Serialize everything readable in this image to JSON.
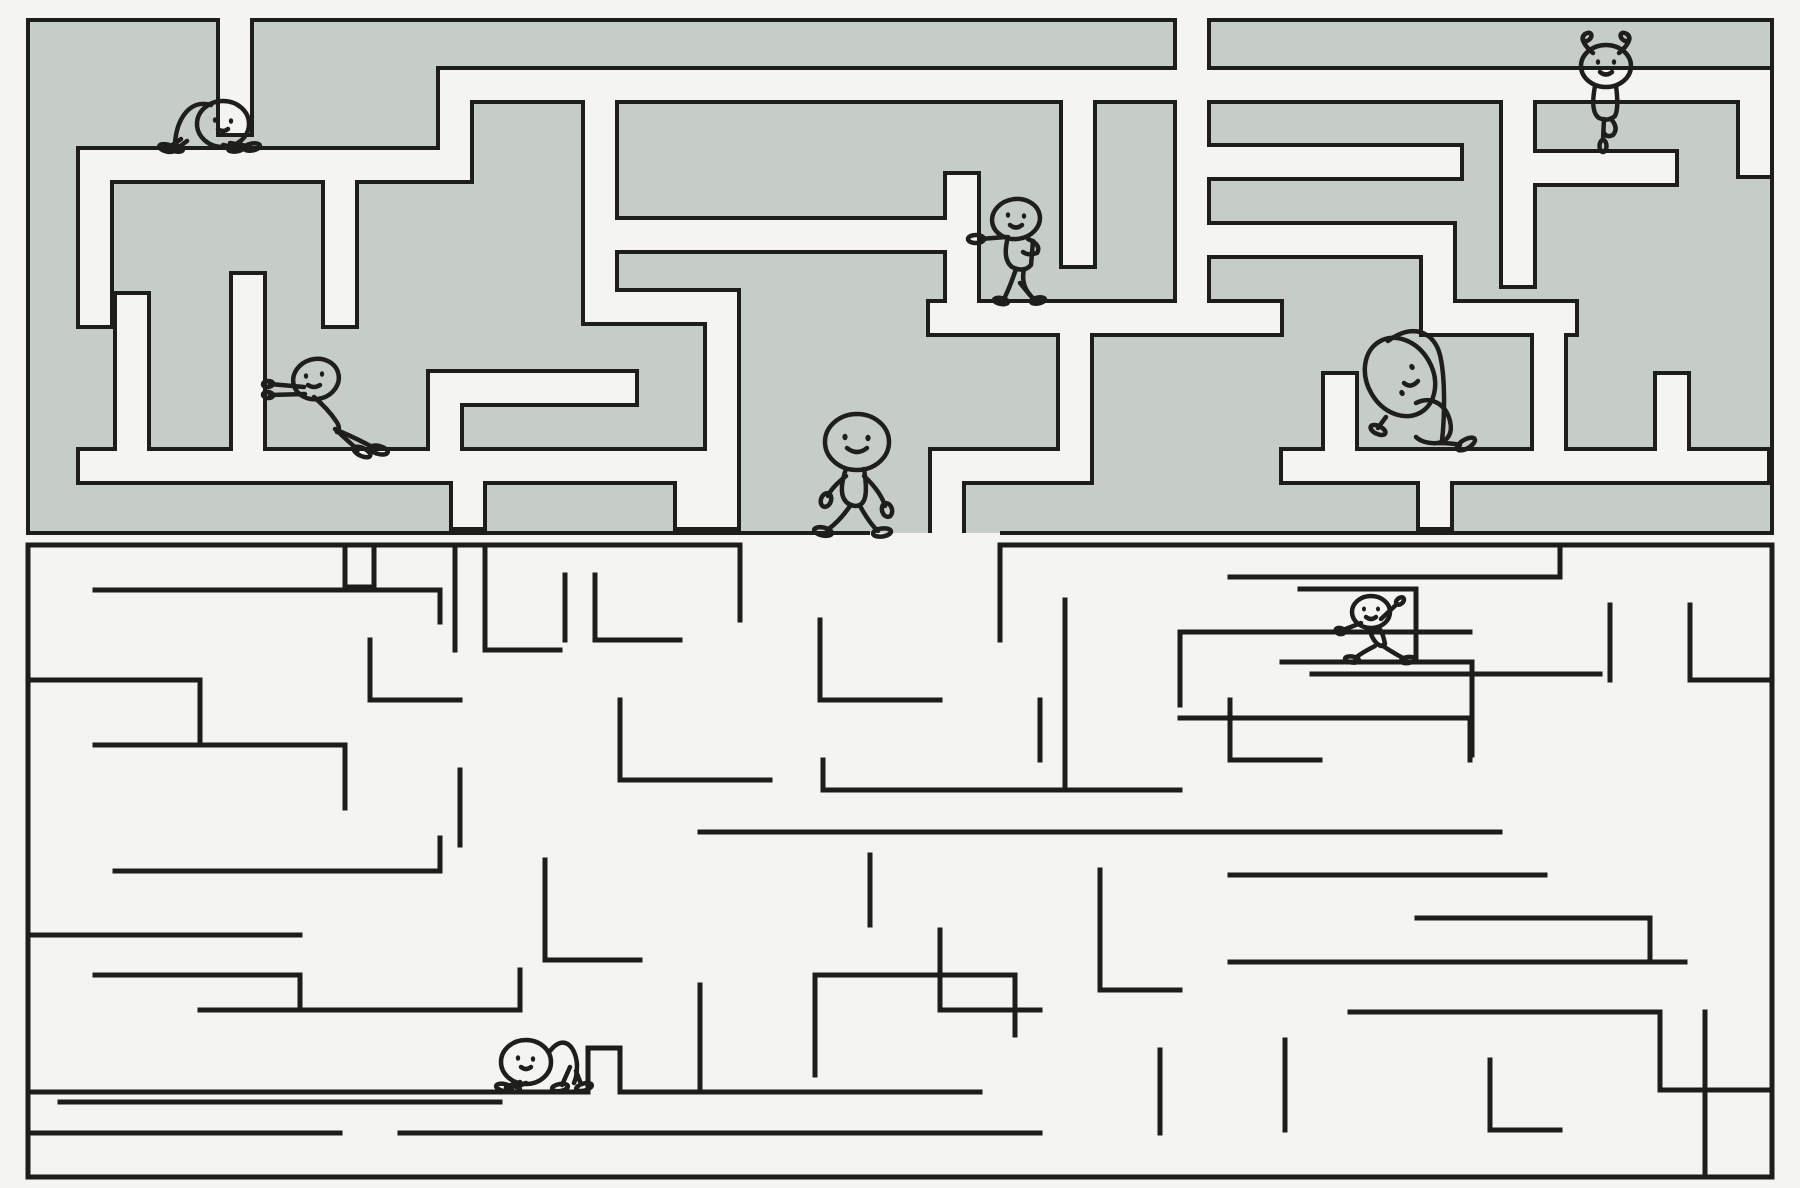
{
  "scene": {
    "width": 1800,
    "height": 1188,
    "background": "#f4f4f1"
  },
  "palette": {
    "maze_fill": "#c6cdc7",
    "wall_line": "#1d1d1b",
    "corridor": "#f4f4f1",
    "figure_line": "#1e1e1c"
  },
  "top_maze": {
    "bounds": {
      "x": 28,
      "y": 20,
      "w": 1744,
      "h": 513
    },
    "outline_width": 4,
    "outline": [
      [
        1000,
        533
      ],
      [
        1772,
        533
      ],
      [
        1772,
        20
      ],
      [
        28,
        20
      ],
      [
        28,
        533
      ],
      [
        870,
        533
      ]
    ],
    "corridor_width": 30,
    "corridor_outline_width": 38,
    "corridors": [
      [
        [
          235,
          10
        ],
        [
          235,
          118
        ]
      ],
      [
        [
          455,
          165
        ],
        [
          95,
          165
        ],
        [
          95,
          310
        ]
      ],
      [
        [
          455,
          85
        ],
        [
          455,
          165
        ]
      ],
      [
        [
          455,
          85
        ],
        [
          1755,
          85
        ],
        [
          1755,
          160
        ]
      ],
      [
        [
          340,
          165
        ],
        [
          340,
          310
        ]
      ],
      [
        [
          600,
          85
        ],
        [
          600,
          307
        ],
        [
          722,
          307
        ],
        [
          722,
          512
        ]
      ],
      [
        [
          600,
          235
        ],
        [
          962,
          235
        ]
      ],
      [
        [
          132,
          310
        ],
        [
          132,
          466
        ]
      ],
      [
        [
          248,
          290
        ],
        [
          248,
          466
        ]
      ],
      [
        [
          95,
          466
        ],
        [
          708,
          466
        ]
      ],
      [
        [
          620,
          388
        ],
        [
          445,
          388
        ],
        [
          445,
          466
        ]
      ],
      [
        [
          468,
          466
        ],
        [
          468,
          512
        ]
      ],
      [
        [
          692,
          466
        ],
        [
          692,
          512
        ]
      ],
      [
        [
          945,
          318
        ],
        [
          1265,
          318
        ]
      ],
      [
        [
          962,
          190
        ],
        [
          962,
          318
        ]
      ],
      [
        [
          1078,
          85
        ],
        [
          1078,
          250
        ]
      ],
      [
        [
          947,
          466
        ],
        [
          947,
          548
        ]
      ],
      [
        [
          947,
          466
        ],
        [
          1075,
          466
        ],
        [
          1075,
          340
        ]
      ],
      [
        [
          1192,
          10
        ],
        [
          1192,
          318
        ]
      ],
      [
        [
          1192,
          162
        ],
        [
          1445,
          162
        ]
      ],
      [
        [
          1192,
          240
        ],
        [
          1438,
          240
        ],
        [
          1438,
          318
        ],
        [
          1560,
          318
        ]
      ],
      [
        [
          1549,
          318
        ],
        [
          1549,
          466
        ]
      ],
      [
        [
          1298,
          466
        ],
        [
          1752,
          466
        ]
      ],
      [
        [
          1340,
          390
        ],
        [
          1340,
          466
        ]
      ],
      [
        [
          1672,
          390
        ],
        [
          1672,
          466
        ]
      ],
      [
        [
          1518,
          85
        ],
        [
          1518,
          270
        ]
      ],
      [
        [
          1518,
          168
        ],
        [
          1660,
          168
        ]
      ],
      [
        [
          1435,
          466
        ],
        [
          1435,
          512
        ]
      ]
    ]
  },
  "bottom_maze": {
    "stroke_width": 5,
    "walls": [
      [
        [
          28,
          545
        ],
        [
          740,
          545
        ]
      ],
      [
        [
          1000,
          545
        ],
        [
          1772,
          545
        ]
      ],
      [
        [
          28,
          545
        ],
        [
          28,
          1177
        ]
      ],
      [
        [
          1772,
          545
        ],
        [
          1772,
          1177
        ]
      ],
      [
        [
          28,
          1177
        ],
        [
          1772,
          1177
        ]
      ],
      [
        [
          345,
          545
        ],
        [
          345,
          587
        ],
        [
          374,
          587
        ],
        [
          374,
          545
        ]
      ],
      [
        [
          95,
          590
        ],
        [
          440,
          590
        ],
        [
          440,
          622
        ]
      ],
      [
        [
          455,
          545
        ],
        [
          455,
          650
        ]
      ],
      [
        [
          485,
          545
        ],
        [
          485,
          650
        ],
        [
          560,
          650
        ]
      ],
      [
        [
          28,
          680
        ],
        [
          200,
          680
        ],
        [
          200,
          745
        ]
      ],
      [
        [
          95,
          745
        ],
        [
          345,
          745
        ],
        [
          345,
          808
        ]
      ],
      [
        [
          115,
          871
        ],
        [
          440,
          871
        ],
        [
          440,
          838
        ]
      ],
      [
        [
          28,
          935
        ],
        [
          300,
          935
        ]
      ],
      [
        [
          95,
          975
        ],
        [
          300,
          975
        ],
        [
          300,
          1010
        ]
      ],
      [
        [
          200,
          1010
        ],
        [
          520,
          1010
        ],
        [
          520,
          970
        ]
      ],
      [
        [
          28,
          1133
        ],
        [
          340,
          1133
        ]
      ],
      [
        [
          400,
          1133
        ],
        [
          1040,
          1133
        ]
      ],
      [
        [
          565,
          575
        ],
        [
          565,
          640
        ]
      ],
      [
        [
          595,
          575
        ],
        [
          595,
          640
        ],
        [
          680,
          640
        ]
      ],
      [
        [
          370,
          640
        ],
        [
          370,
          700
        ],
        [
          460,
          700
        ]
      ],
      [
        [
          620,
          700
        ],
        [
          620,
          780
        ],
        [
          770,
          780
        ]
      ],
      [
        [
          460,
          770
        ],
        [
          460,
          845
        ]
      ],
      [
        [
          545,
          860
        ],
        [
          545,
          960
        ],
        [
          640,
          960
        ]
      ],
      [
        [
          700,
          985
        ],
        [
          700,
          1092
        ]
      ],
      [
        [
          28,
          1092
        ],
        [
          588,
          1092
        ]
      ],
      [
        [
          588,
          1048
        ],
        [
          588,
          1092
        ]
      ],
      [
        [
          588,
          1048
        ],
        [
          620,
          1048
        ]
      ],
      [
        [
          620,
          1048
        ],
        [
          620,
          1092
        ]
      ],
      [
        [
          620,
          1092
        ],
        [
          980,
          1092
        ]
      ],
      [
        [
          60,
          1102
        ],
        [
          500,
          1102
        ]
      ],
      [
        [
          740,
          545
        ],
        [
          740,
          620
        ]
      ],
      [
        [
          1000,
          545
        ],
        [
          1000,
          640
        ]
      ],
      [
        [
          820,
          620
        ],
        [
          820,
          700
        ],
        [
          940,
          700
        ]
      ],
      [
        [
          823,
          760
        ],
        [
          823,
          790
        ],
        [
          1180,
          790
        ]
      ],
      [
        [
          700,
          832
        ],
        [
          1500,
          832
        ]
      ],
      [
        [
          1065,
          600
        ],
        [
          1065,
          790
        ]
      ],
      [
        [
          1180,
          705
        ],
        [
          1180,
          632
        ],
        [
          1470,
          632
        ]
      ],
      [
        [
          1180,
          718
        ],
        [
          1470,
          718
        ],
        [
          1470,
          760
        ]
      ],
      [
        [
          1230,
          577
        ],
        [
          1560,
          577
        ],
        [
          1560,
          545
        ]
      ],
      [
        [
          1300,
          589
        ],
        [
          1416,
          589
        ],
        [
          1416,
          662
        ]
      ],
      [
        [
          1282,
          662
        ],
        [
          1472,
          662
        ]
      ],
      [
        [
          1312,
          674
        ],
        [
          1600,
          674
        ]
      ],
      [
        [
          1472,
          662
        ],
        [
          1472,
          755
        ]
      ],
      [
        [
          1610,
          605
        ],
        [
          1610,
          680
        ]
      ],
      [
        [
          1690,
          605
        ],
        [
          1690,
          680
        ],
        [
          1772,
          680
        ]
      ],
      [
        [
          1230,
          875
        ],
        [
          1545,
          875
        ]
      ],
      [
        [
          1417,
          918
        ],
        [
          1650,
          918
        ],
        [
          1650,
          962
        ]
      ],
      [
        [
          1230,
          962
        ],
        [
          1685,
          962
        ]
      ],
      [
        [
          1705,
          1012
        ],
        [
          1705,
          1177
        ]
      ],
      [
        [
          1350,
          1012
        ],
        [
          1660,
          1012
        ],
        [
          1660,
          1090
        ]
      ],
      [
        [
          1660,
          1090
        ],
        [
          1772,
          1090
        ]
      ],
      [
        [
          1490,
          1060
        ],
        [
          1490,
          1130
        ],
        [
          1560,
          1130
        ]
      ],
      [
        [
          1285,
          1040
        ],
        [
          1285,
          1130
        ]
      ],
      [
        [
          1100,
          870
        ],
        [
          1100,
          990
        ],
        [
          1180,
          990
        ]
      ],
      [
        [
          1160,
          1050
        ],
        [
          1160,
          1133
        ]
      ],
      [
        [
          940,
          930
        ],
        [
          940,
          1010
        ],
        [
          1040,
          1010
        ]
      ],
      [
        [
          1040,
          700
        ],
        [
          1040,
          760
        ]
      ],
      [
        [
          815,
          1075
        ],
        [
          815,
          975
        ],
        [
          1015,
          975
        ],
        [
          1015,
          1035
        ]
      ],
      [
        [
          870,
          855
        ],
        [
          870,
          925
        ]
      ],
      [
        [
          1230,
          700
        ],
        [
          1230,
          760
        ],
        [
          1320,
          760
        ]
      ]
    ]
  },
  "characters": [
    {
      "name": "figure-cat-stretch",
      "pose": "crawl-right",
      "x": 205,
      "y": 151
    },
    {
      "name": "figure-tree-pose",
      "pose": "tree",
      "x": 1606,
      "y": 152
    },
    {
      "name": "figure-lean-wall",
      "pose": "lean",
      "x": 1018,
      "y": 303
    },
    {
      "name": "figure-push-wall",
      "pose": "push",
      "x": 320,
      "y": 455
    },
    {
      "name": "figure-walker",
      "pose": "walk",
      "x": 855,
      "y": 534
    },
    {
      "name": "figure-side-stretch",
      "pose": "sit-stretch",
      "x": 1412,
      "y": 453
    },
    {
      "name": "figure-lunge",
      "pose": "lunge",
      "x": 1375,
      "y": 661
    },
    {
      "name": "figure-crawl-left",
      "pose": "crawl-left",
      "x": 540,
      "y": 1091
    }
  ]
}
